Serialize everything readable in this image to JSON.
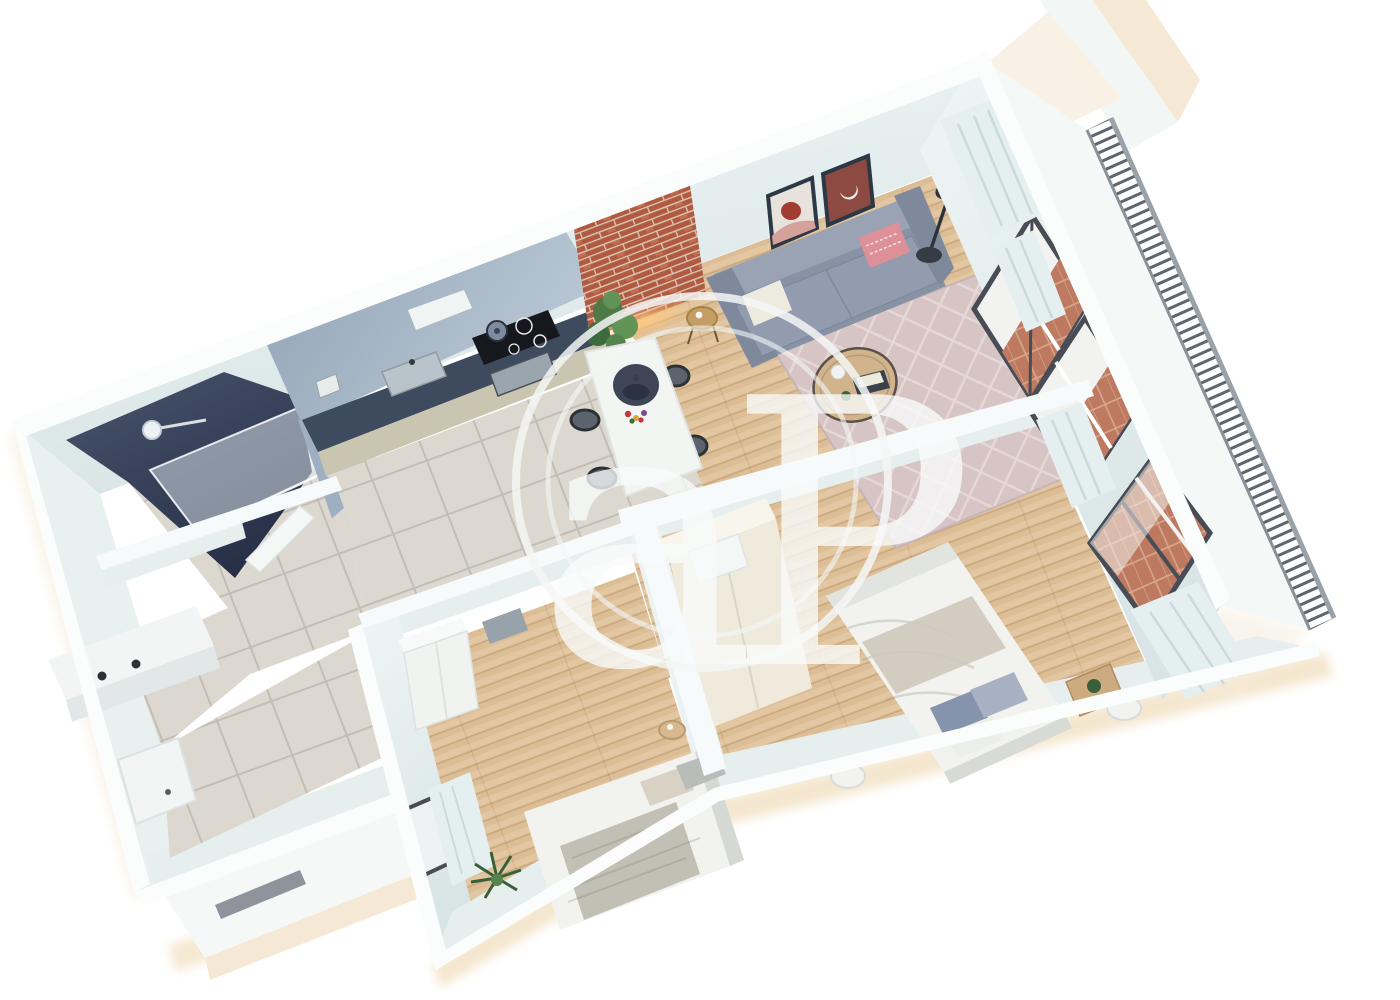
{
  "scene": {
    "type": "3d-floorplan-render",
    "background": "#ffffff",
    "view": "isometric-top-down"
  },
  "watermark": {
    "text": "aP"
  },
  "palette": {
    "wall_face": "#e6efee",
    "wall_top": "#fbfdfd",
    "accent_navy": "#39435a",
    "kitchen_wall": "#a6b7c6",
    "counter_top": "#3e4a5e",
    "cabinet_front": "#c9c5b0",
    "tile_floor": "#dcd8d0",
    "wood_floor": "#dcbe96",
    "rug": "#d7c5c5",
    "sofa": "#8792a5",
    "pillow_pink": "#dd9097",
    "brick": "#b05a42",
    "brick_balcony_floor": "#bd7a61",
    "window_frame": "#474c55",
    "railing_slat": "#5d666f",
    "curtain": "#e6efef",
    "duvet": "#f2f2ee",
    "pillow_blue": "#8593ad",
    "wardrobe_cream": "#efeadb",
    "plant_green": "#4e7a46",
    "exterior_cream": "#f5e9d5"
  },
  "rooms": [
    {
      "name": "bathroom",
      "floor": "tile",
      "features": [
        "navy-accent-wall",
        "walk-in-shower",
        "glass-screen",
        "shower-head",
        "toilet",
        "vanity-two-faucets"
      ]
    },
    {
      "name": "kitchen",
      "floor": "tile",
      "features": [
        "l-shaped-counter",
        "steel-sink",
        "induction-cooktop",
        "oven",
        "pot",
        "kettle",
        "tall-column"
      ]
    },
    {
      "name": "dining-area",
      "floor": "wood",
      "features": [
        "white-table",
        "navy-pendant-lamp",
        "flower-vase",
        "four-black-chairs",
        "fiddle-leaf-plant"
      ]
    },
    {
      "name": "living-room",
      "floor": "wood",
      "features": [
        "gray-sofa",
        "white-pillow",
        "pink-pillow",
        "wall-art-circle",
        "wall-art-moon",
        "floor-lamp",
        "round-coffee-table",
        "brass-side-table",
        "patterned-rug",
        "brick-accent-panel",
        "balcony-windows"
      ]
    },
    {
      "name": "entry-hall",
      "floor": "tile",
      "features": [
        "entry-door",
        "porch-step"
      ]
    },
    {
      "name": "bedroom-small",
      "floor": "wood",
      "features": [
        "single-bed",
        "white-wardrobe",
        "round-side-table",
        "palm-plant",
        "window-with-curtain"
      ]
    },
    {
      "name": "bedroom-master",
      "floor": "wood",
      "features": [
        "double-bed",
        "blue-pillows",
        "cream-wardrobe",
        "round-nightstand-west",
        "round-nightstand-east",
        "plant-side-table",
        "balcony-window",
        "curtains"
      ]
    },
    {
      "name": "balcony",
      "floor": "brick-herringbone",
      "features": [
        "slat-railing"
      ]
    }
  ]
}
